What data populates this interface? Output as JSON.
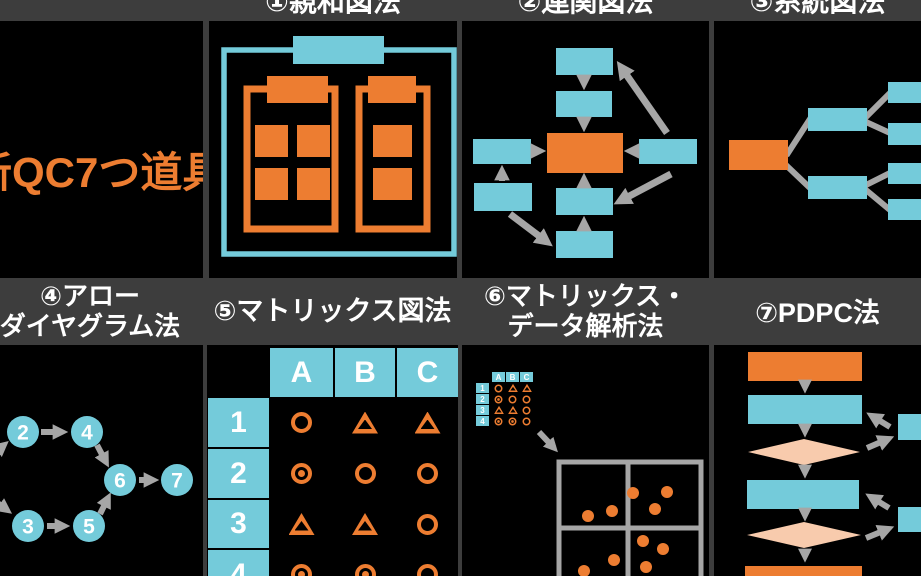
{
  "colors": {
    "orange": "#ED7D31",
    "cyan": "#74CBDA",
    "gray": "#A6A6A6",
    "peach": "#F8CBAD",
    "band": "#3D3D3D",
    "panel": "#000000",
    "white": "#FFFFFF"
  },
  "title": {
    "text": "新QC7つ道具"
  },
  "headers": {
    "affinity": "①親和図法",
    "relation": "②連関図法",
    "tree": "③系統図法",
    "arrow_line1": "④アロー",
    "arrow_line2": "ダイヤグラム法",
    "matrix": "⑤マトリックス図法",
    "matrix_data_line1": "⑥マトリックス・",
    "matrix_data_line2": "データ解析法",
    "pdpc": "⑦PDPC法"
  },
  "arrow_diagram": {
    "nodes": [
      "2",
      "4",
      "6",
      "7",
      "3",
      "5"
    ]
  },
  "matrix": {
    "columns": [
      "A",
      "B",
      "C"
    ],
    "rows": [
      "1",
      "2",
      "3",
      "4"
    ],
    "cells": [
      [
        "circle",
        "triangle",
        "triangle"
      ],
      [
        "double",
        "circle",
        "circle"
      ],
      [
        "triangle",
        "triangle",
        "circle"
      ],
      [
        "double",
        "double",
        "circle"
      ]
    ]
  }
}
